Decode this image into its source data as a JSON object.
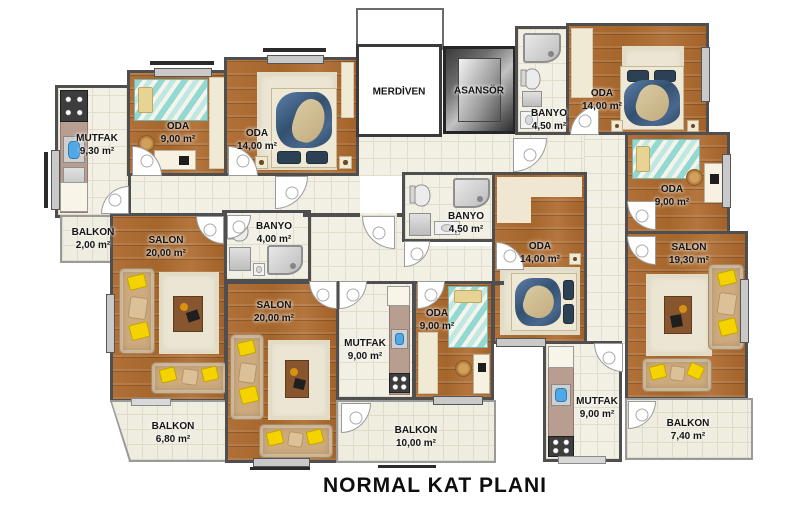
{
  "title": "NORMAL KAT PLANI",
  "rooms": {
    "mutfak_a": {
      "name": "MUTFAK",
      "area": "9,30 m²"
    },
    "oda9_a": {
      "name": "ODA",
      "area": "9,00 m²"
    },
    "oda14_a": {
      "name": "ODA",
      "area": "14,00 m²"
    },
    "balkon2": {
      "name": "BALKON",
      "area": "2,00 m²"
    },
    "banyo4_a": {
      "name": "BANYO",
      "area": "4,00 m²"
    },
    "salon_a": {
      "name": "SALON",
      "area": "20,00 m²"
    },
    "balkon68": {
      "name": "BALKON",
      "area": "6,80 m²"
    },
    "merdiven": {
      "name": "MERDİVEN",
      "area": ""
    },
    "asansor": {
      "name": "ASANSÖR",
      "area": ""
    },
    "banyo45_b": {
      "name": "BANYO",
      "area": "4,50 m²"
    },
    "oda14_b": {
      "name": "ODA",
      "area": "14,00 m²"
    },
    "oda9_b": {
      "name": "ODA",
      "area": "9,00 m²"
    },
    "mutfak_b": {
      "name": "MUTFAK",
      "area": "9,00 m²"
    },
    "salon_b": {
      "name": "SALON",
      "area": "20,00 m²"
    },
    "balkon10": {
      "name": "BALKON",
      "area": "10,00 m²"
    },
    "banyo45_c": {
      "name": "BANYO",
      "area": "4,50 m²"
    },
    "oda14_c": {
      "name": "ODA",
      "area": "14,00 m²"
    },
    "oda9_c": {
      "name": "ODA",
      "area": "9,00 m²"
    },
    "salon_c": {
      "name": "SALON",
      "area": "19,30 m²"
    },
    "mutfak_c": {
      "name": "MUTFAK",
      "area": "9,00 m²"
    },
    "balkon74": {
      "name": "BALKON",
      "area": "7,40 m²"
    }
  },
  "colors": {
    "wall": "#4f4f4f",
    "wood_floor": "#ad6c33",
    "tile_floor": "#f2efe4",
    "sofa": "#cdab7e",
    "accent_pillow": "#f4d301",
    "bed_blanket": "#33516f",
    "single_bed_teal": "#93d8d1",
    "counter": "#b89e90",
    "sink_blue": "#4fa8e8"
  }
}
